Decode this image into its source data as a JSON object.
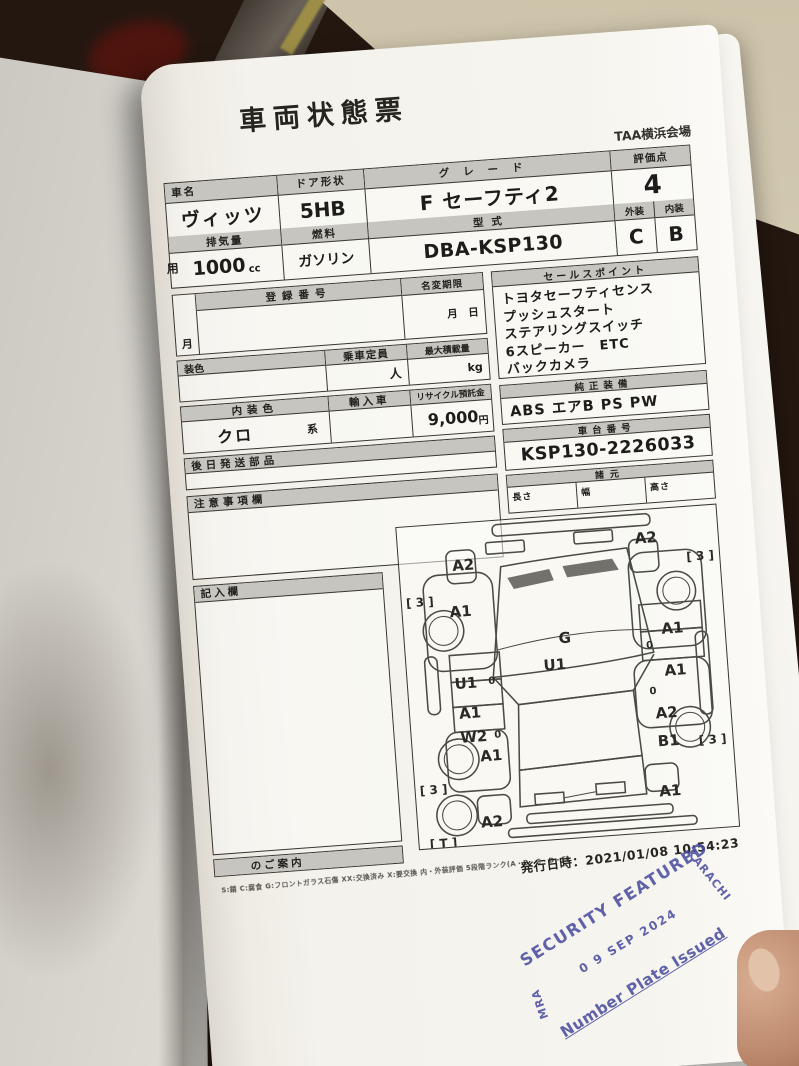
{
  "photo": {
    "colors": {
      "background_dark": "#241710",
      "surface_tan": "#cdc3aa",
      "paper": "#f4f2ec",
      "stamp_ink": "#4b4f9f"
    }
  },
  "sheet": {
    "title": "車両状態票",
    "venue": "TAA横浜会場",
    "fields": {
      "car_name_label": "車名",
      "car_name": "ヴィッツ",
      "door_label": "ドア形状",
      "door_value": "5HB",
      "grade_label": "グレード",
      "grade_value": "F セーフティ2",
      "score_label": "評価点",
      "score_value": "4",
      "usage_partial": "用",
      "displacement_label": "排気量",
      "displacement_value": "1000",
      "displacement_unit": "cc",
      "fuel_label": "燃料",
      "fuel_value": "ガソリン",
      "model_label": "型式",
      "model_value": "DBA-KSP130",
      "exterior_label": "外装",
      "exterior_grade": "C",
      "interior_label": "内装",
      "interior_grade": "B",
      "reg_label": "登録番号",
      "reg_month_partial": "月",
      "namechange_label": "名変期限",
      "namechange_value": "月　日",
      "capacity_label": "乗車定員",
      "capacity_unit": "人",
      "payload_label": "最大積載量",
      "payload_unit": "kg",
      "extcolor_partial": "装色",
      "intcolor_label": "内装色",
      "intcolor_value": "クロ",
      "intcolor_suffix": "系",
      "import_label": "輸入車",
      "recycle_label": "リサイクル預託金",
      "recycle_value": "9,000",
      "recycle_unit": "円",
      "later_parts_label": "後日発送部品",
      "notes_label": "注意事項欄",
      "entry_label": "記入欄",
      "guide_label": "のご案内",
      "sales_label": "セールスポイント",
      "oem_label": "純正装備",
      "oem_value": "ABS エアB PS PW",
      "vin_label": "車台番号",
      "vin_value": "KSP130-2226033",
      "spec_label": "諸元",
      "spec_length": "長さ",
      "spec_width": "幅",
      "spec_height": "高さ"
    },
    "sales_points": [
      "トヨタセーフティセンス",
      "プッシュスタート",
      "ステアリングスイッチ",
      "6スピーカー　ETC",
      "バックカメラ"
    ],
    "diagram": {
      "markers": [
        {
          "t": "A2",
          "x": 62,
          "y": 40
        },
        {
          "t": "A2",
          "x": 246,
          "y": 26
        },
        {
          "t": "[ 3 ]",
          "x": 299,
          "y": 48,
          "s": 12
        },
        {
          "t": "[ 3 ]",
          "x": 16,
          "y": 74,
          "s": 12
        },
        {
          "t": "A1",
          "x": 56,
          "y": 86
        },
        {
          "t": "G",
          "x": 158,
          "y": 120
        },
        {
          "t": "A1",
          "x": 266,
          "y": 118
        },
        {
          "t": "U1",
          "x": 146,
          "y": 146
        },
        {
          "t": "U1",
          "x": 56,
          "y": 158
        },
        {
          "t": "0",
          "x": 82,
          "y": 158,
          "s": 10
        },
        {
          "t": "0",
          "x": 242,
          "y": 134,
          "s": 10
        },
        {
          "t": "A1",
          "x": 266,
          "y": 160
        },
        {
          "t": "A1",
          "x": 58,
          "y": 188
        },
        {
          "t": "W2",
          "x": 60,
          "y": 212
        },
        {
          "t": "0",
          "x": 84,
          "y": 212,
          "s": 10
        },
        {
          "t": "0",
          "x": 242,
          "y": 180,
          "s": 10
        },
        {
          "t": "A2",
          "x": 254,
          "y": 202
        },
        {
          "t": "A1",
          "x": 76,
          "y": 232
        },
        {
          "t": "B1",
          "x": 254,
          "y": 230
        },
        {
          "t": "[ 3 ]",
          "x": 298,
          "y": 232,
          "s": 12
        },
        {
          "t": "[ 3 ]",
          "x": 16,
          "y": 262,
          "s": 12
        },
        {
          "t": "A1",
          "x": 252,
          "y": 280
        },
        {
          "t": "A2",
          "x": 72,
          "y": 298
        },
        {
          "t": "[ T ]",
          "x": 22,
          "y": 316,
          "s": 12
        }
      ]
    },
    "legend": "S:錆 C:腐食 G:フロントガラス石傷 XX:交換済み X:要交換 内・外装評価 5段階ランク(A・B・C・D・E)",
    "issued_label": "発行日時：",
    "issued_datetime": "2021/01/08 10:54:23"
  },
  "stamp": {
    "arc_text": "SECURITY FEATURED",
    "right_text": "KARACHI",
    "date": "0 9 SEP 2024",
    "left_text": "MRA",
    "bottom_text": "Number Plate Issued"
  }
}
